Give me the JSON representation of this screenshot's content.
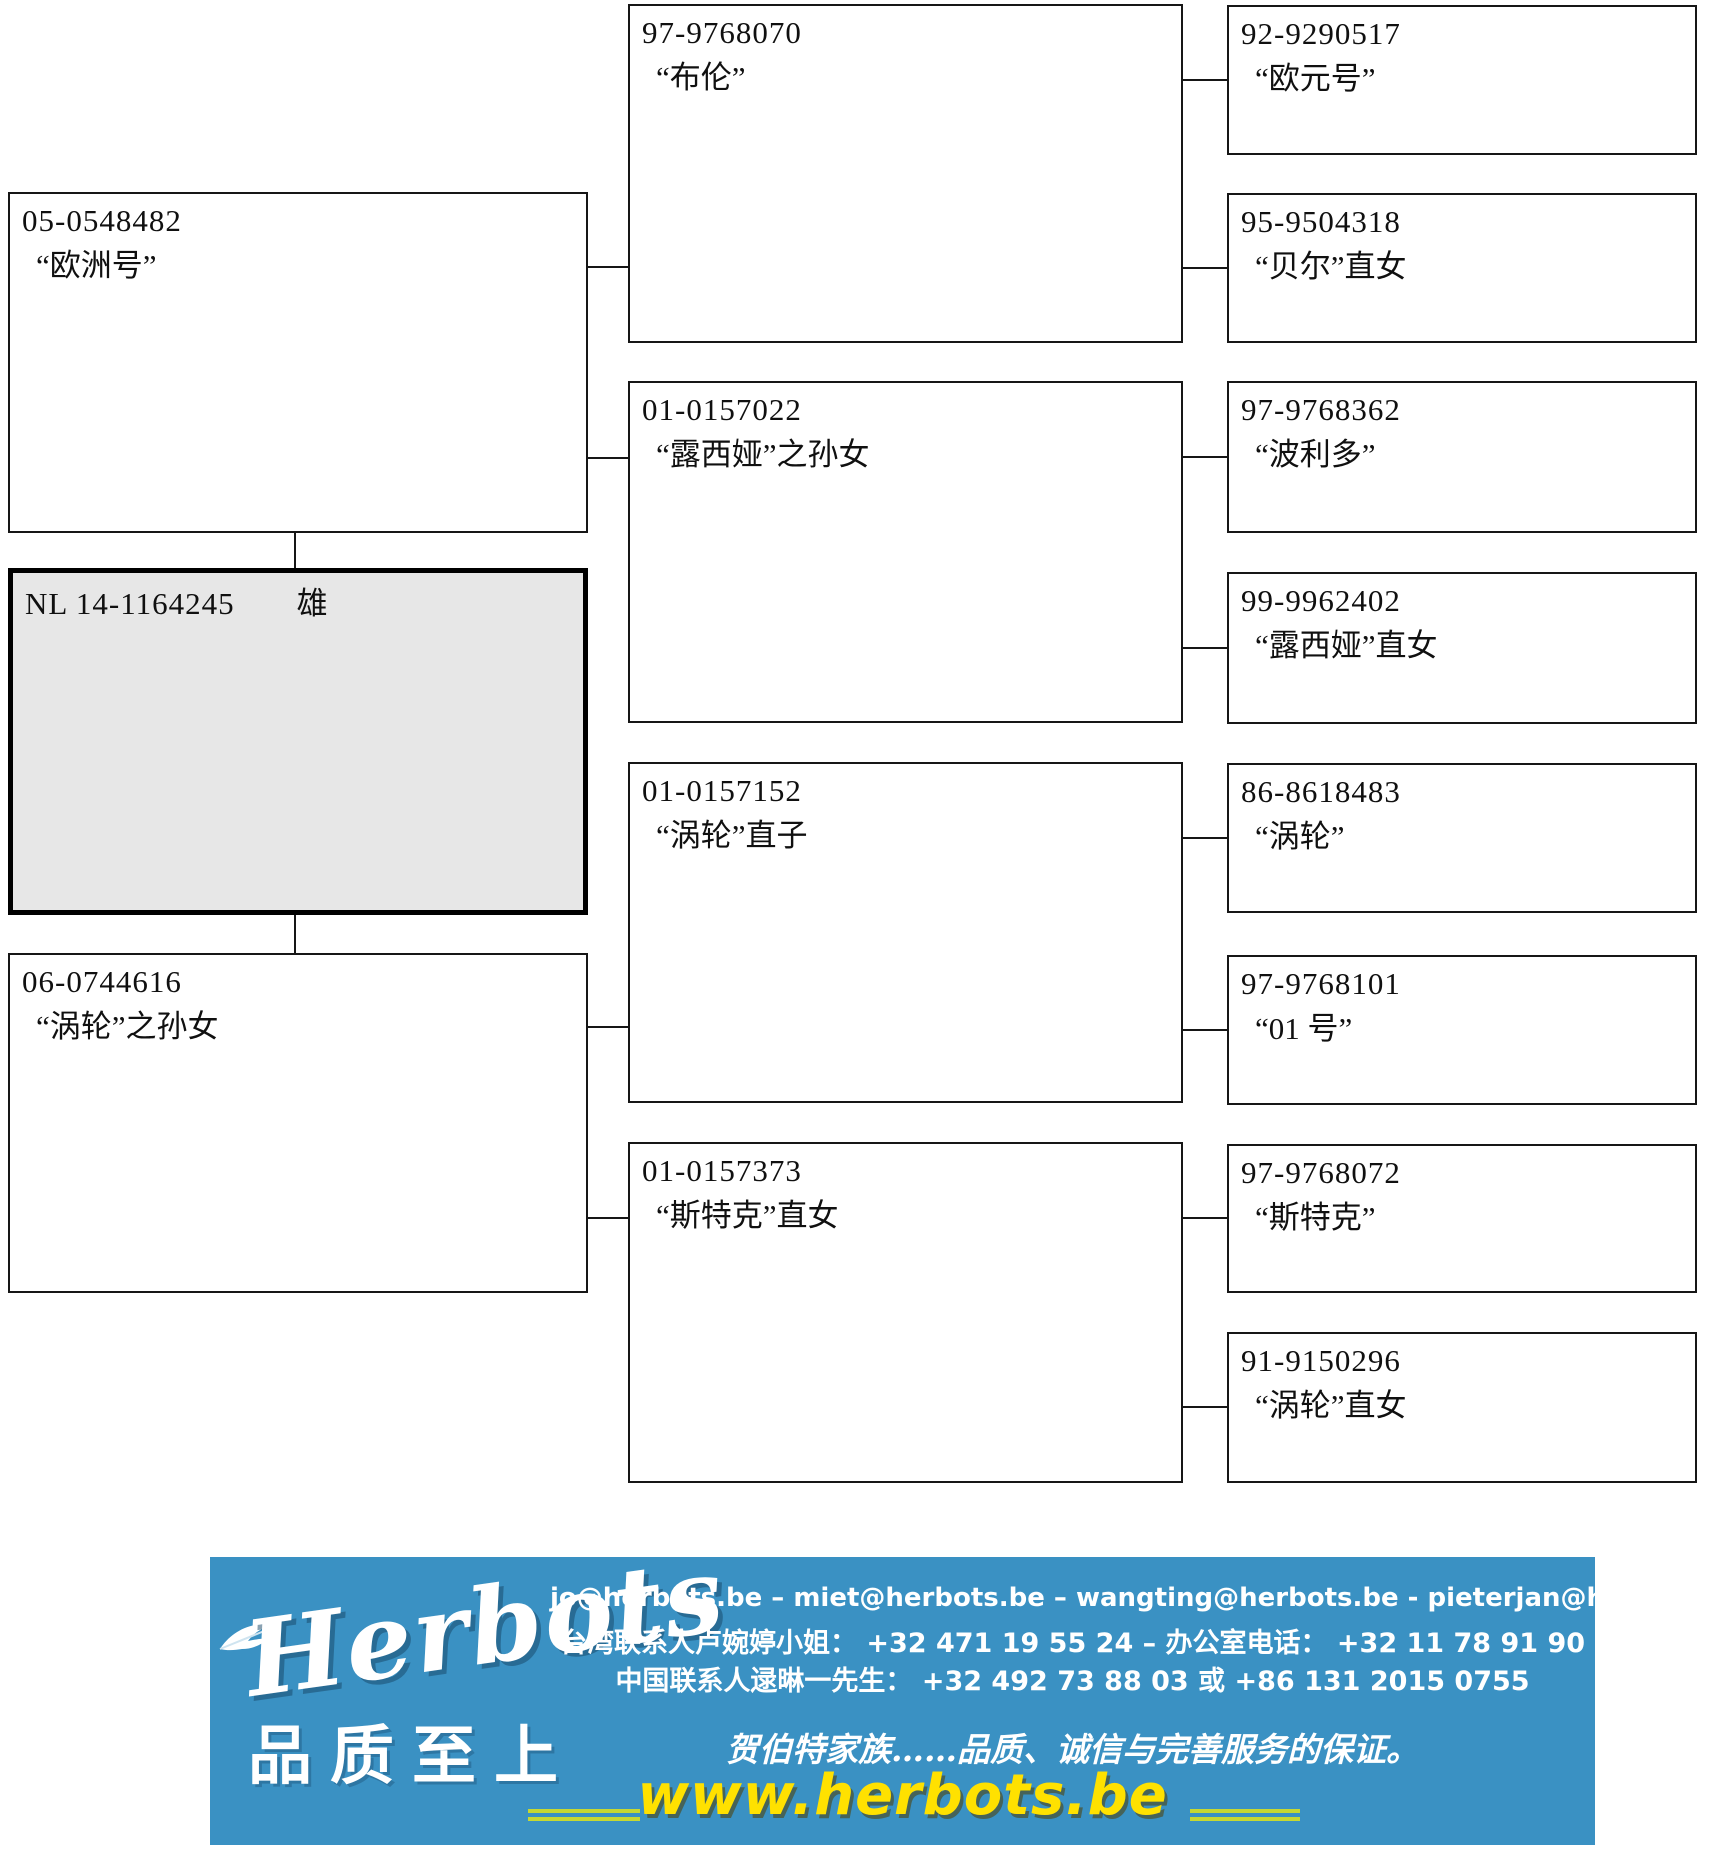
{
  "pedigree": {
    "subject": {
      "ring": "NL 14-1164245",
      "sex": "雄"
    },
    "parents": [
      {
        "ring": "05-0548482",
        "name": "“欧洲号”"
      },
      {
        "ring": "06-0744616",
        "name": "“涡轮”之孙女"
      }
    ],
    "grandparents": [
      {
        "ring": "97-9768070",
        "name": "“布伦”"
      },
      {
        "ring": "01-0157022",
        "name": "“露西娅”之孙女"
      },
      {
        "ring": "01-0157152",
        "name": "“涡轮”直子"
      },
      {
        "ring": "01-0157373",
        "name": "“斯特克”直女"
      }
    ],
    "great_grandparents": [
      {
        "ring": "92-9290517",
        "name": "“欧元号”"
      },
      {
        "ring": "95-9504318",
        "name": "“贝尔”直女"
      },
      {
        "ring": "97-9768362",
        "name": "“波利多”"
      },
      {
        "ring": "99-9962402",
        "name": "“露西娅”直女"
      },
      {
        "ring": "86-8618483",
        "name": "“涡轮”"
      },
      {
        "ring": "97-9768101",
        "name": "“01 号”"
      },
      {
        "ring": "97-9768072",
        "name": "“斯特克”"
      },
      {
        "ring": "91-9150296",
        "name": "“涡轮”直女"
      }
    ]
  },
  "banner": {
    "logo_text": "Herbots",
    "logo_subtitle": "品质至上",
    "emails": "jo@herbots.be – miet@herbots.be – wangting@herbots.be - pieterjan@herbots.be",
    "contact_taiwan": "台湾联系人卢婉婷小姐： +32 471 19 55 24  – 办公室电话： +32 11 78 91 90",
    "contact_china": "中国联系人逯晽一先生： +32 492 73 88 03 或 +86 131 2015 0755",
    "slogan": "贺伯特家族……品质、诚信与完善服务的保证。",
    "website": "www.herbots.be",
    "colors": {
      "background": "#3a91c3",
      "website_yellow": "#ffe100",
      "accent_line": "#c6d832",
      "text": "#ffffff",
      "subject_box_fill": "#e7e7e7"
    }
  }
}
